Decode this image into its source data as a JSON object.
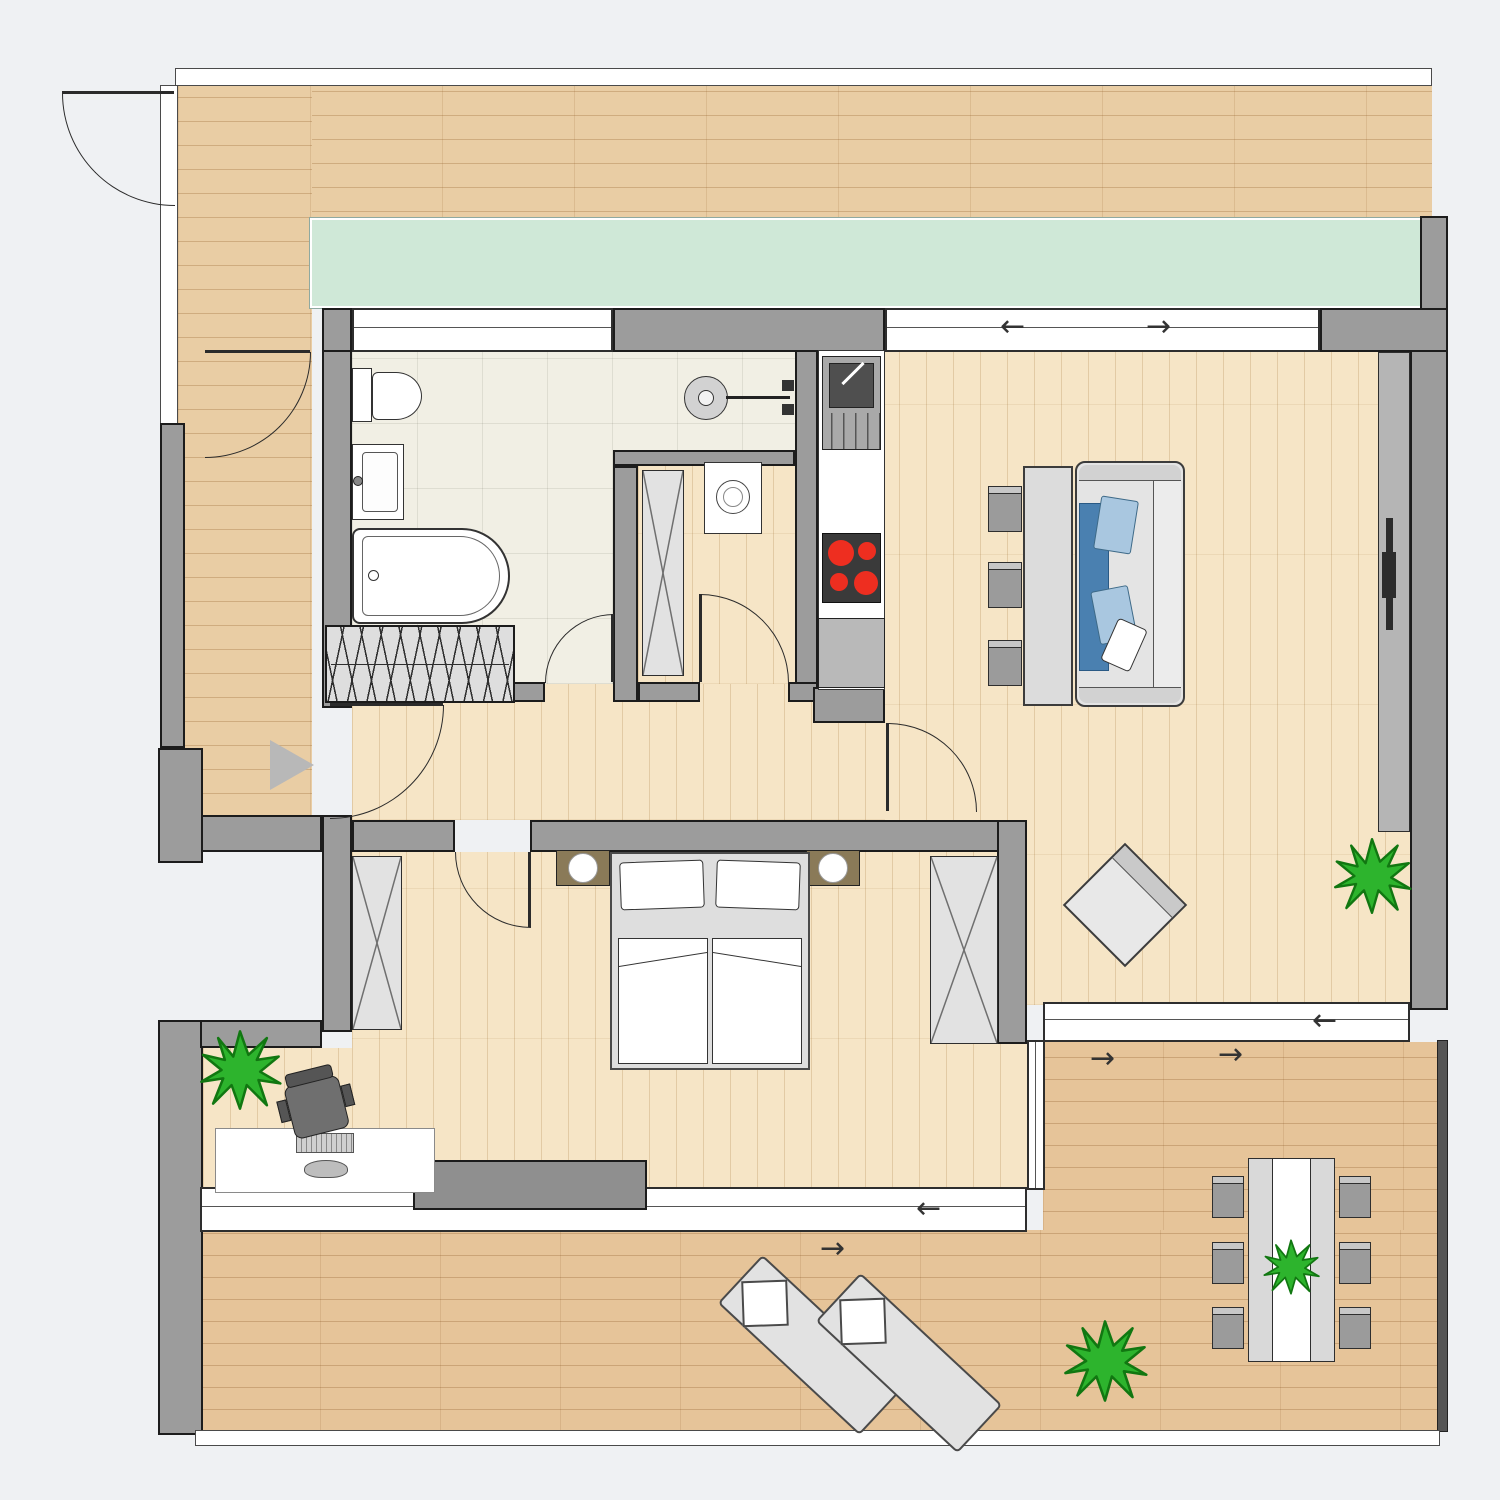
{
  "plan": {
    "title": "apartment-floor-plan",
    "arrows": {
      "left": "←",
      "right": "→"
    },
    "colors": {
      "background": "#eff1f3",
      "wall_fill": "#9c9c9c",
      "wall_stroke": "#1c1c1c",
      "balcony_wood": "#e9cda4",
      "terrace_wood": "#e6c499",
      "interior_wood": "#f6e5c6",
      "bathroom_tile": "#f1efe4",
      "planter_green": "#cfe8d7",
      "furniture_gray": "#e4e4e4",
      "chair_gray": "#9b9b9b",
      "sofa_blanket_blue": "#4a80b0",
      "sofa_pillow_blue": "#a9c7e0",
      "nightstand_brown": "#8a7a58",
      "stove_red": "#ee2e20",
      "plant_green": "#2db42d",
      "entry_marker_gray": "#b8b8b8"
    },
    "rooms": [
      {
        "name": "bathroom"
      },
      {
        "name": "utility-closet"
      },
      {
        "name": "kitchen"
      },
      {
        "name": "hallway"
      },
      {
        "name": "living-room"
      },
      {
        "name": "bedroom"
      },
      {
        "name": "office-nook"
      },
      {
        "name": "balcony-top"
      },
      {
        "name": "terrace-bottom"
      },
      {
        "name": "planter-strip"
      }
    ],
    "fixtures": [
      "toilet",
      "washbasin",
      "bathtub",
      "shower",
      "coat-rack",
      "washing-machine",
      "wardrobe",
      "kitchen-sink",
      "stove",
      "kitchen-cabinet",
      "sofa",
      "side-table",
      "dining-chairs",
      "armchair",
      "tv-sideboard",
      "tv",
      "double-bed",
      "pillows",
      "nightstands",
      "bed-lamps",
      "dresser",
      "desk",
      "keyboard",
      "mouse",
      "office-chair",
      "sun-loungers",
      "outdoor-dining-table",
      "outdoor-chairs",
      "plants",
      "entry-arrow",
      "door-swings",
      "sliding-windows"
    ]
  }
}
